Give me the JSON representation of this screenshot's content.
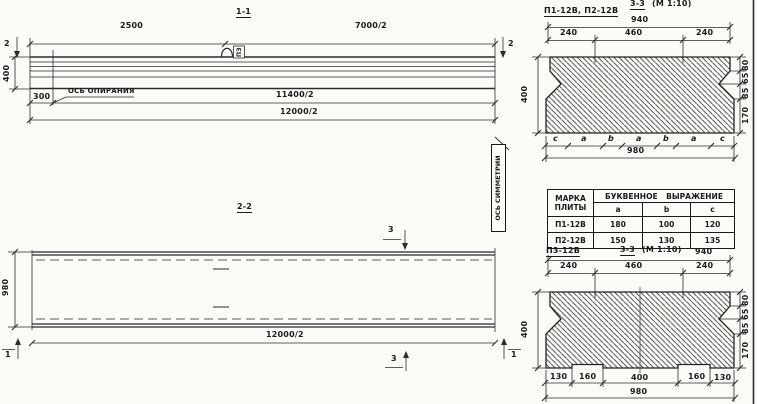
{
  "view_1_1": {
    "title": "1-1",
    "dim_top_left": "2500",
    "dim_top_right": "7000/2",
    "cut_mark": "2",
    "dim_height": "400",
    "dim_offset": "300",
    "bearing_axis_label": "ОСЬ ОПИРАНИЯ",
    "dim_mid": "11400/2",
    "dim_bottom": "12000/2",
    "loop_tag": "ПЗ"
  },
  "view_2_2": {
    "title": "2-2",
    "cut_mark_3": "3",
    "cut_mark_1": "1",
    "dim_width": "980",
    "dim_bottom": "12000/2"
  },
  "symmetry_axis_label": "ОСЬ СИММЕТРИИ",
  "section_3_3_top": {
    "label": "П1-12В, П2-12В",
    "title": "3-3",
    "scale": "(М 1:10)",
    "dim_top_total": "940",
    "dims_top": [
      "240",
      "460",
      "240"
    ],
    "dim_height": "400",
    "dims_right": [
      "80",
      "65",
      "85",
      "170"
    ],
    "letter_dims": [
      "c",
      "a",
      "b",
      "a",
      "b",
      "a",
      "c"
    ],
    "dim_bottom_total": "980"
  },
  "table": {
    "header_col1_line1": "МАРКА",
    "header_col1_line2": "ПЛИТЫ",
    "header_span": "БУКВЕННОЕ ВЫРАЖЕНИЕ",
    "columns": [
      "a",
      "b",
      "c"
    ],
    "rows": [
      {
        "mark": "П1-12В",
        "a": "180",
        "b": "100",
        "c": "120"
      },
      {
        "mark": "П2-12В",
        "a": "150",
        "b": "130",
        "c": "135"
      }
    ]
  },
  "section_3_3_bottom": {
    "label": "П3-12В",
    "title": "3-3",
    "scale": "(М 1:10)",
    "dim_top_total": "940",
    "dims_top": [
      "240",
      "460",
      "240"
    ],
    "dim_height": "400",
    "dims_right": [
      "80",
      "65",
      "85",
      "170"
    ],
    "dims_bottom": [
      "130",
      "160",
      "400",
      "160",
      "130"
    ],
    "dim_bottom_total": "980"
  }
}
